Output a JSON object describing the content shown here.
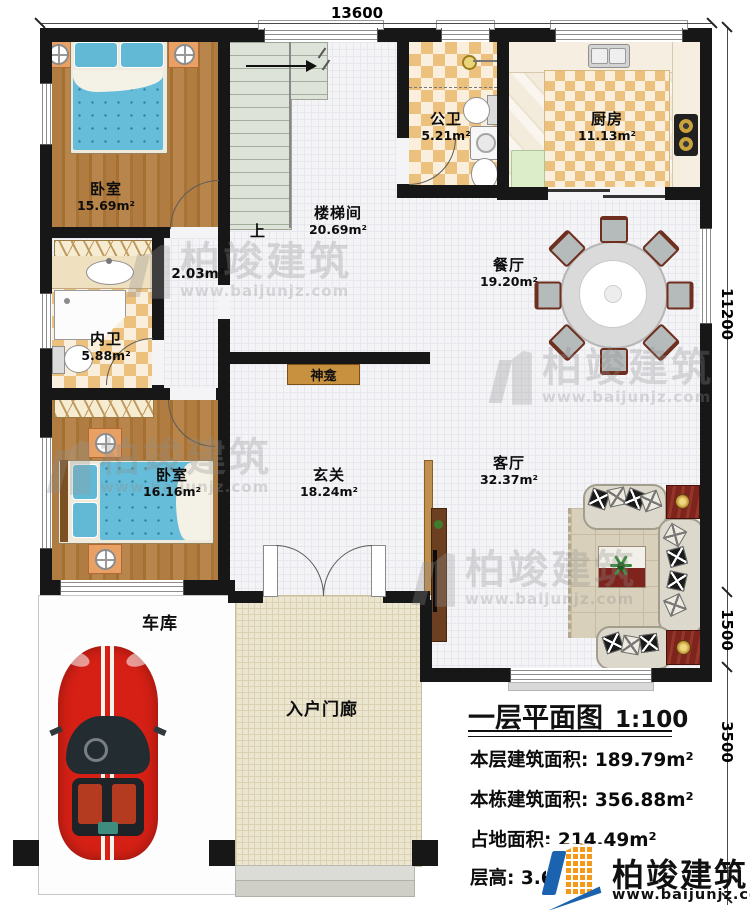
{
  "plan": {
    "dims": {
      "top": "13600",
      "right_upper": "11200",
      "right_mid": "1500",
      "right_lower": "3500"
    },
    "rooms": {
      "bedroom1": {
        "name": "卧室",
        "area": "15.69m²"
      },
      "stairwell": {
        "name": "楼梯间",
        "area": "20.69m²"
      },
      "corridor": {
        "area": "2.03m²"
      },
      "public_bath": {
        "name": "公卫",
        "area": "5.21m²"
      },
      "kitchen": {
        "name": "厨房",
        "area": "11.13m²"
      },
      "dining": {
        "name": "餐厅",
        "area": "19.20m²"
      },
      "private_bath": {
        "name": "内卫",
        "area": "5.88m²"
      },
      "bedroom2": {
        "name": "卧室",
        "area": "16.16m²"
      },
      "foyer": {
        "name": "玄关",
        "area": "18.24m²"
      },
      "living": {
        "name": "客厅",
        "area": "32.37m²"
      },
      "shrine": {
        "name": "神龛"
      },
      "garage": {
        "name": "车库"
      },
      "porch": {
        "name": "入户门廊"
      }
    },
    "stairs": {
      "up": "上"
    }
  },
  "title_block": {
    "title": "一层平面图",
    "scale": "1:100",
    "rows": [
      {
        "label": "本层建筑面积:",
        "value": "189.79m²"
      },
      {
        "label": "本栋建筑面积:",
        "value": "356.88m²"
      },
      {
        "label": "占地面积:",
        "value": "214.49m²"
      },
      {
        "label": "层高:",
        "value": "3.6m"
      }
    ]
  },
  "brand": {
    "name": "柏竣建筑",
    "url": "www.baijunjz.com"
  },
  "colors": {
    "wall": "#171717",
    "wood": "#b07c42",
    "tile_checker": "#ecc17e",
    "logo_blue": "#1b63ae",
    "logo_orange": "#f49a18",
    "car_red": "#d62015",
    "accent_red_table": "#7d241c"
  }
}
